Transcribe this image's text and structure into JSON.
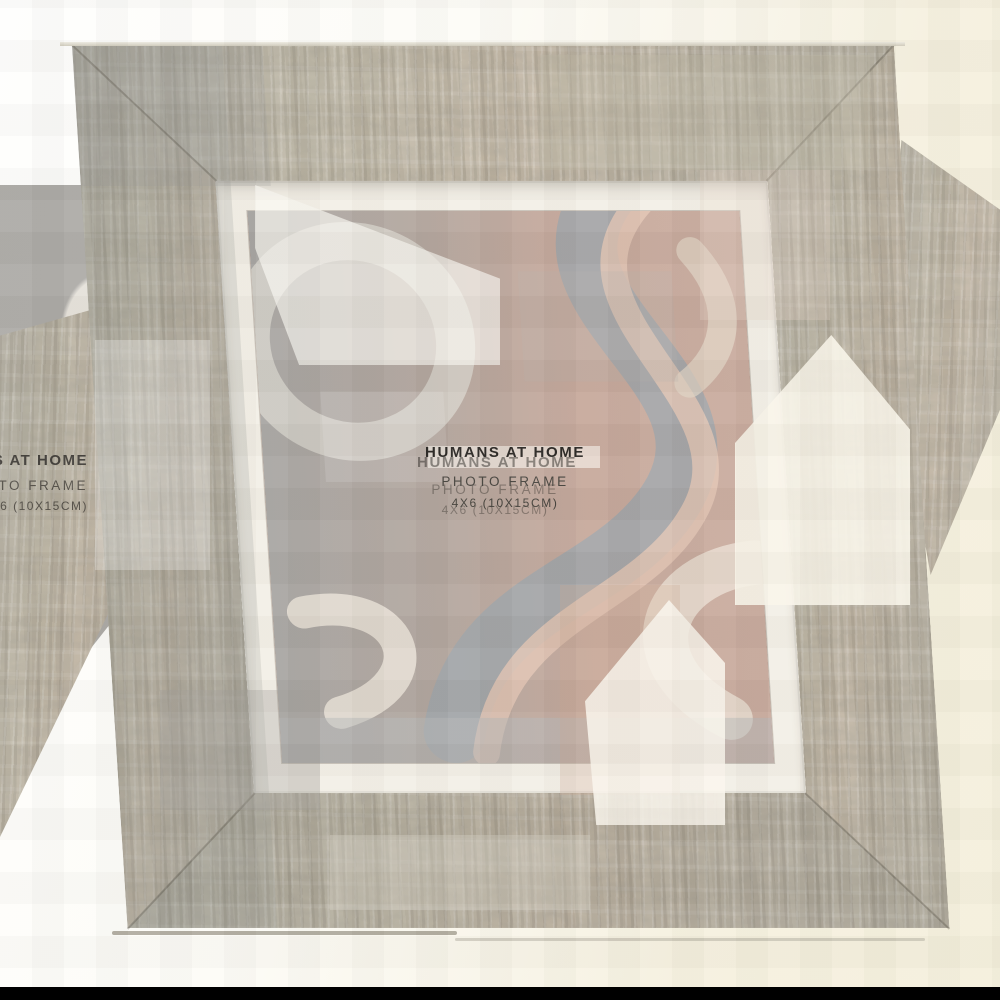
{
  "product_card": {
    "brand": "HUMANS AT HOME",
    "product": "PHOTO FRAME",
    "size": "4X6 (10X15CM)"
  },
  "colors": {
    "background_white": "#fefefd",
    "background_ivory": "#f6f1df",
    "wood_base": "#b6b0a2",
    "wood_light": "#cec9bb",
    "wood_dark": "#8f897a",
    "mat": "#f3efe6",
    "art_pink": "#c79f8f",
    "art_grey_blue": "#9fa5a9",
    "art_pale_pink": "#e3c5b4",
    "art_cream": "#e9dfd3",
    "text_dark": "#2a2724",
    "bottom_bar": "#000000"
  }
}
